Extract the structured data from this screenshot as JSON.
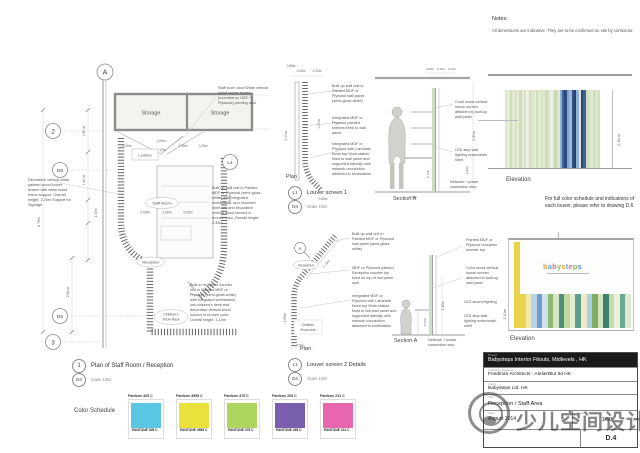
{
  "notes": {
    "title": "Notes:",
    "body": "All dimensions are indicative. They are to be confirmed on site by contractor."
  },
  "plan": {
    "grid_markers": {
      "a": "A",
      "two": "2",
      "d6": "D6",
      "d5": "D5",
      "three": "3",
      "l1": "L1"
    },
    "rooms": {
      "storage1": "Storage",
      "storage2": "Storage",
      "lockers": "Lockers",
      "staff_room": "Staff Room",
      "reception": "Reception",
      "show_rack_1": "Children's",
      "show_rack_2": "Show Rack"
    },
    "dims": {
      "d1": "1.60m",
      "d2": "1.12m",
      "d3": "0.40m",
      "d4": "0.25m",
      "d15": "0.25m",
      "d5": "0.80 m",
      "d6": "1.60 m",
      "d7": "1.15m",
      "d8": "6.70m",
      "d9": "2.85 m",
      "d10": "0.65M",
      "d11": "1.06m",
      "d12": "0.05m",
      "d13": "1.60m",
      "d14": "2.10m"
    },
    "notes": {
      "left": "Decorative vertical white painted wood louver screen with white wood frame support. Overall height: 2.20m Support for Signage",
      "door": "Staff room door White vertical wood louver screen (mounted on MDF + Plywood) pivoting door",
      "wall_unit": "Built up wall unit in Painted MDF or Plywood (semi-gloss white) with integrated workstation, and mounted shelf unit and decorative vertical wood louvers in bronze color. Overall height: 2.30m",
      "reception_unit": "Built-in reception counter unit in Painted MDF or Plywood (semi-gloss white) with integrated workstation, low children's desk and decorative vertical wood louvers in bronze color. Overall height: 1.10m"
    },
    "title": {
      "num": "1",
      "sheet": "D4",
      "label": "Plan of Staff Room / Reception",
      "scale": "Scale  1/50"
    }
  },
  "screen1": {
    "plan_label": "Plan",
    "section_label": "Section A",
    "dims": {
      "t1": "0.65m",
      "t2": "0.06m",
      "t3": "0.15m",
      "r1": "1.90m",
      "l1": "2.10m",
      "b1": "0.60m"
    },
    "section_dims": {
      "t1": "0.06m",
      "t2": "0.13m",
      "t3": "0.24m",
      "r1": "2.30m",
      "r2": "0.90m",
      "m1": "0.72m",
      "b1": "0.60m"
    },
    "notes": {
      "wall_panel": "Built up wall unit in Painted MDF or Plywood wall panel (semi-gloss white)",
      "shelves": "Integrated MDF or Plywood painted shelves fixed to wall panel",
      "workstation": "Integrated MDF or Plywood with Laminate finish top Work station fixed to wall panel and supported laterally with network connection attached to workstation",
      "louver": "Color wood vertical louver screen attached to built-up wall panel",
      "led": "LED strip wall lighting underneath shelf",
      "network": "Network + power connection step"
    },
    "title": {
      "num": "L1",
      "sheet": "D4",
      "label": "Louver screen 1",
      "scale": "Scale  1/50"
    }
  },
  "screen2": {
    "plan_label": "Plan",
    "section_label": "Section A",
    "marker_a": "A",
    "labels": {
      "reception": "Reception",
      "show_rack_1": "Children",
      "show_rack_2": "Show rack"
    },
    "dims": {
      "diag": "2.10m",
      "v1": "1.06m",
      "b1": "0.05m",
      "m1": "0.72m",
      "l1": "1.10m"
    },
    "notes": {
      "wall_panel": "Built up wall unit in Painted MDF or Plywood wall panel (semi-gloss white)",
      "counter_top": "MDF or Plywood painted Reception counter top fixed on top of low panel wall",
      "workstation": "Integrated MDF or Plywood with Laminate finish top Work station fixed to low wall panel and supported laterally with network connection attached to workstation",
      "painted_top": "Painted MDF or Plywood reception counter top",
      "louver": "Color wood vertical louver screen attached to built-up wall panel",
      "led_accent": "LED accent lighting",
      "led_strip": "LED strip wall lighting underneath shelf",
      "network": "Network + power connection step"
    },
    "title": {
      "num": "L1",
      "sheet": "D4",
      "label": "Louver screen 2 Details",
      "scale": "Scale  1/50"
    }
  },
  "elevation1": {
    "label": "Elevation",
    "dim": "2.30 m",
    "stripes": [
      "#dce7cb",
      "#e7ecd8",
      "#cfdfba",
      "#e3ead2",
      "#d7e3c2",
      "#eceadf",
      "#cdddb8",
      "#e7ecd8",
      "#d7e3c2",
      "#f0eee3",
      "#d2e0bd",
      "#dce7cb",
      "#e7ecd8",
      "#cfdfba",
      "#e3ead2",
      "#d7e3c2",
      "#e7e5d4",
      "#cdddb8",
      "#dce7cb",
      "#eef0e6",
      "#d2e0bd",
      "#c7d8b0",
      "#dce7cb",
      "#8fb3d6",
      "#41639b",
      "#2d4a7e",
      "#7ba3cc",
      "#9db8d8",
      "#35507f",
      "#27406f",
      "#8fb3d6",
      "#dce7cb",
      "#2d4a7e",
      "#41639b",
      "#cfdfba",
      "#d7e3c2",
      "#e7ecd8",
      "#cdddb8",
      "#dce7cb",
      "#d2e0bd"
    ]
  },
  "elevation2": {
    "label": "Elevation",
    "dim": "1.10m",
    "left_stripe": "#e8d34b",
    "logo_letters": [
      {
        "ch": "b",
        "c": "#e6a33c"
      },
      {
        "ch": "a",
        "c": "#5fa8d8"
      },
      {
        "ch": "b",
        "c": "#e06a9e"
      },
      {
        "ch": "y",
        "c": "#8cba5e"
      },
      {
        "ch": "s",
        "c": "#e6a33c"
      },
      {
        "ch": "t",
        "c": "#5fa8d8"
      },
      {
        "ch": "e",
        "c": "#e06a9e"
      },
      {
        "ch": "p",
        "c": "#8cba5e"
      },
      {
        "ch": "s",
        "c": "#4f93c4"
      }
    ],
    "stripes": [
      "#e8d34b",
      "#f2e9b0",
      "#b8d3e8",
      "#6f9fca",
      "#cfe0ef",
      "#8fba6f",
      "#d9e6c4",
      "#4f8f7a",
      "#bcd9a0",
      "#e4ecd4",
      "#5e9f8b",
      "#f0e9c8",
      "#a8cfe4",
      "#7fb05f",
      "#d2e4bf",
      "#3f7f6e",
      "#c4dca8",
      "#e8f0dc",
      "#6aa892",
      "#dde8cc"
    ]
  },
  "full_color_note": "For full color schedule and indications of each louver, please refer to drawing D.6",
  "color_schedule": {
    "label": "Color Schedule",
    "swatches": [
      {
        "label": "Pantone 305 C",
        "card_text": "PANTONE 305 C",
        "color": "#59c6e3"
      },
      {
        "label": "Pantone 3955 C",
        "card_text": "PANTONE 3955 C",
        "color": "#ebe13c"
      },
      {
        "label": "Pantone 375 C",
        "card_text": "PANTONE 375 C",
        "color": "#aed55e"
      },
      {
        "label": "Pantone 265 C",
        "card_text": "PANTONE 265 C",
        "color": "#7a5fae"
      },
      {
        "label": "Pantone 231 C",
        "card_text": "PANTONE 231 C",
        "color": "#e866ae"
      }
    ]
  },
  "title_block": {
    "project_label": "Project",
    "project": "Babysteps Interior Fitouts, Midlevels , HK",
    "architect_label": "Architect / Designer",
    "architect": "Friedman Architects - AtelierBlur ltd HK",
    "client_label": "Client",
    "client": "Babysteps Ltd. HK",
    "title_label": "Title",
    "title": "Reception / Staff Area",
    "date_label": "Date",
    "date": "August 2014",
    "scale_label": "Scale",
    "scale": "1/50",
    "drawing_no": "D.4"
  },
  "watermark": {
    "text": "少儿空间设计"
  }
}
